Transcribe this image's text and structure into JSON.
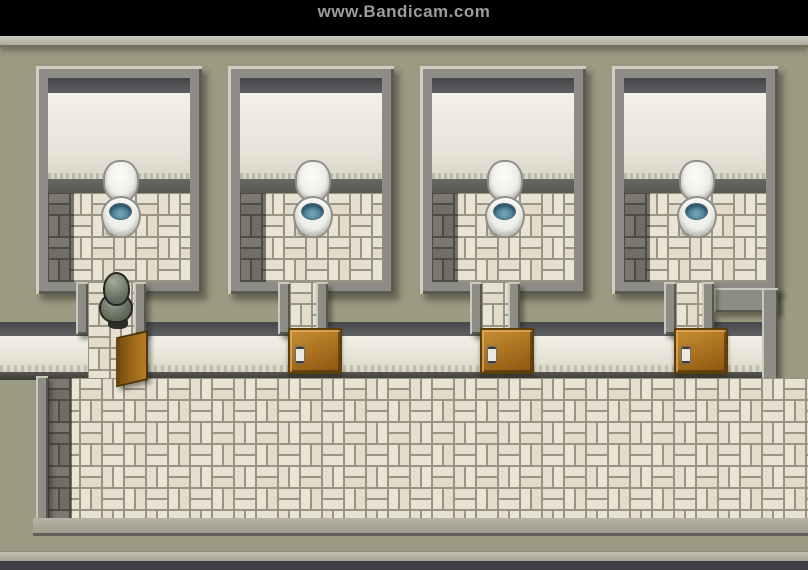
{
  "watermark": {
    "text": "www.Bandicam.com",
    "bar_color": "#000000",
    "text_color": "#9c9c9c"
  },
  "scene": {
    "game_style": "top-down RPG interior (RPG Maker style)",
    "location": "public restroom with four toilet stalls and a tiled hallway",
    "stalls": [
      {
        "id": 1,
        "toilet": "lid-raised",
        "door_state": "open",
        "occupied_by": "player"
      },
      {
        "id": 2,
        "toilet": "lid-raised",
        "door_state": "closed"
      },
      {
        "id": 3,
        "toilet": "lid-raised",
        "door_state": "closed"
      },
      {
        "id": 4,
        "toilet": "lid-raised",
        "door_state": "closed"
      }
    ],
    "player": {
      "sprite": "gray-hooded-character",
      "position": "standing in stall 1 doorway",
      "facing": "up"
    },
    "colors": {
      "wall_olive": "#9b9a82",
      "wall_trim_gray": "#8d8d85",
      "stall_inner_wall": "#ece9de",
      "floor_tile_light": "#e7e1d2",
      "floor_grout": "#9a9484",
      "floor_tile_dark": "#74716a",
      "door_brown": "#a86f1d",
      "toilet_white": "#f1f1ec",
      "toilet_water_blue": "#4a7f96",
      "shadow_band": "#55555a"
    }
  }
}
